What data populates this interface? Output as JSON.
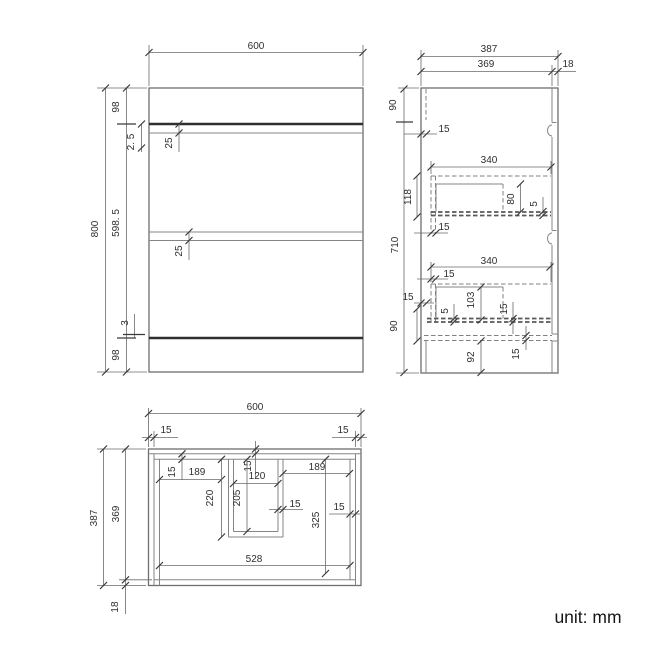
{
  "unit_label": "unit: mm",
  "front_view": {
    "dims": {
      "width": "600",
      "height": "800",
      "top_panel": "98",
      "top_gap": "2. 5",
      "top_rail": "25",
      "body": "598. 5",
      "mid_rail": "25",
      "bottom_gap": "3",
      "plinth": "98"
    }
  },
  "side_view": {
    "dims": {
      "depth": "387",
      "body_depth": "369",
      "back_offset": "18",
      "top_height": "90",
      "front_thickness": "15",
      "height": "710",
      "drawer1_depth": "340",
      "drawer1_height": "118",
      "drawer1_box": "80",
      "drawer1_gap": "5",
      "drawer1_side": "15",
      "drawer2_depth": "340",
      "drawer2_front": "15",
      "drawer2_left": "15",
      "drawer2_box": "103",
      "drawer2_gap": "5",
      "drawer2_bottom": "15",
      "plinth_zone": "90",
      "bottom_height": "92",
      "bottom_panel": "15"
    }
  },
  "plan_view": {
    "dims": {
      "width": "600",
      "wall_left": "15",
      "wall_right": "15",
      "depth": "387",
      "inner_depth": "369",
      "back_gap": "18",
      "left_inset": "15",
      "left_bay": "189",
      "divider_depth": "220",
      "cutout_top": "15",
      "cutout_width": "120",
      "cutout_depth": "205",
      "cutout_wall": "15",
      "right_bay": "189",
      "right_depth": "325",
      "right_wall": "15",
      "inner_width": "528"
    }
  }
}
